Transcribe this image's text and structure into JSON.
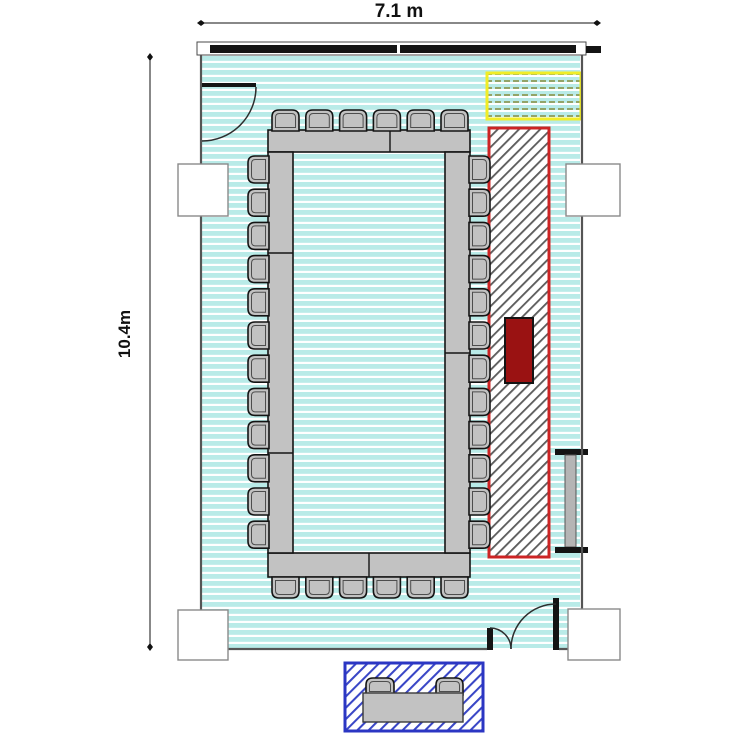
{
  "dimensions": {
    "width_label": "7.1 m",
    "height_label": "10.4m"
  },
  "furniture": {
    "conference_chairs": {
      "top": 6,
      "bottom": 6,
      "left": 12,
      "right": 12,
      "total": 36
    },
    "desk_chairs": 2,
    "table_arrangement": "hollow-rectangle"
  },
  "zones": {
    "red_hatched_zone": "diagonal-hatched strip along right side",
    "yellow_hatched_zone": "dashed-hatched rectangle at top right",
    "blue_hatched_zone": "diagonal-hatched reception desk area outside bottom wall",
    "dark_red_box": "solid dark red equipment block inside red zone"
  },
  "colors": {
    "floor_stripe": "#b9ebe8",
    "wall": "#555555",
    "window_band": "#141414",
    "furniture_gray": "#c2c2c2",
    "outline": "#141414",
    "red_zone_border": "#cc2424",
    "hatch_gray": "#5c5c5c",
    "dark_red_box": "#9a1212",
    "yellow_zone_border": "#f1ed27",
    "yellow_zone_dash": "#93a468",
    "blue_zone_border": "#2b36c3",
    "blue_zone_hatch": "#3946c6",
    "dimension_text": "#111111"
  }
}
